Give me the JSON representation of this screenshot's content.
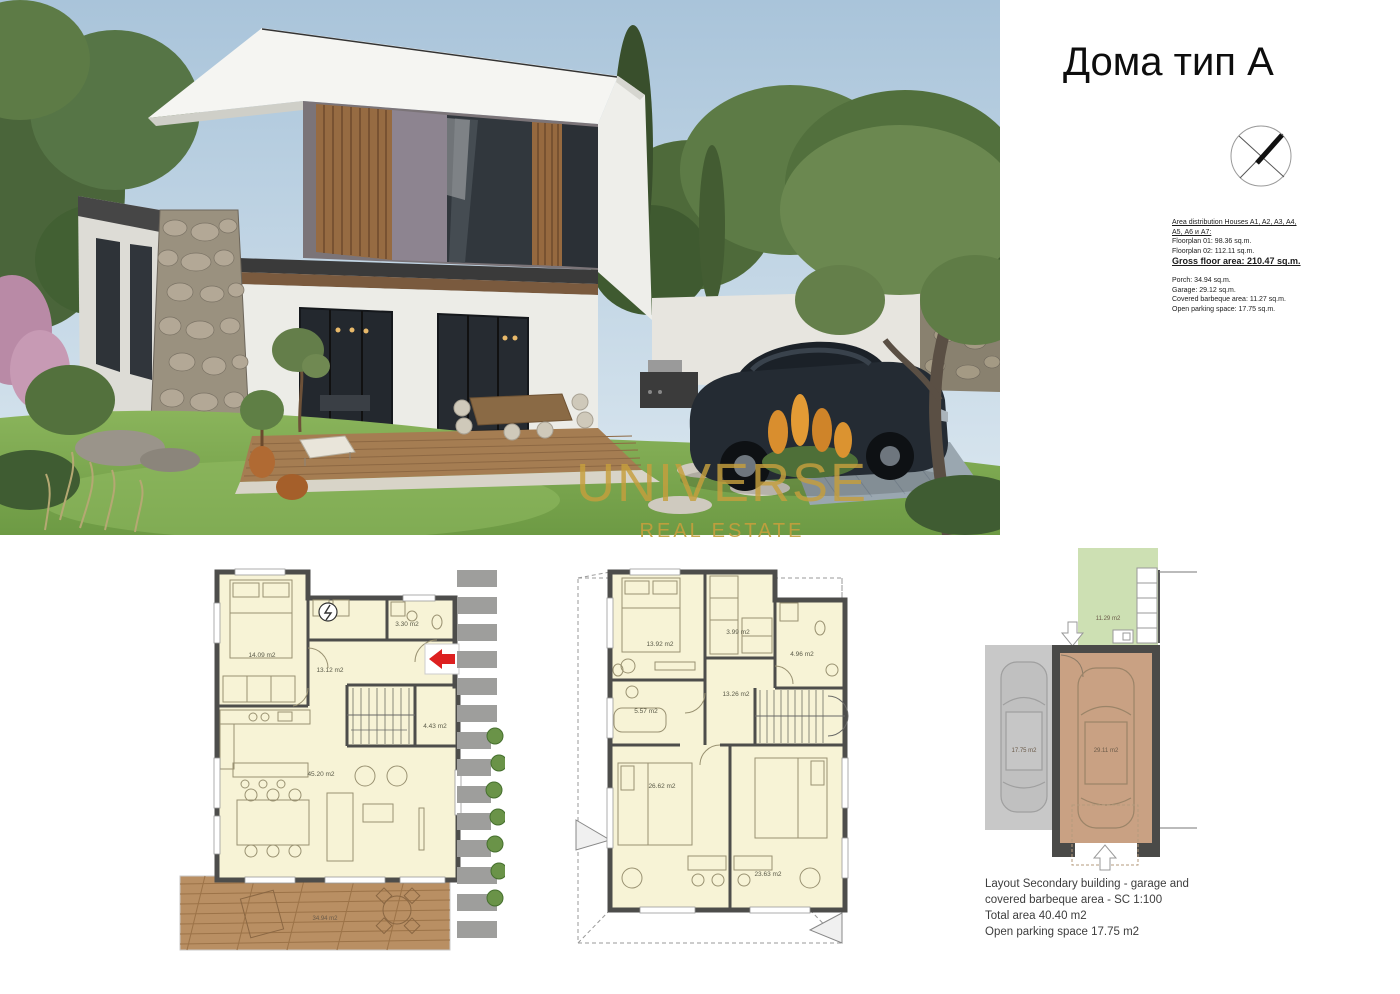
{
  "header": {
    "title": "Дома тип А"
  },
  "watermark": {
    "brand": "UNIVERSE",
    "sub": "REAL ESTATE",
    "color": "#c69f3d"
  },
  "info_block": {
    "heading_line1": "Area distribution Houses A1, A2, A3, A4,",
    "heading_line2": "A5, А6 и А7:",
    "floorplan01": "Floorplan 01: 98.36 sq.m.",
    "floorplan02": "Floorplan 02: 112.11 sq.m.",
    "gross": "Gross floor area: 210.47 sq.m.",
    "porch": "Porch: 34.94 sq.m.",
    "garage": "Garage: 29.12 sq.m.",
    "bbq": "Covered barbeque area: 11.27 sq.m.",
    "parking": "Open parking space: 17.75 sq.m."
  },
  "floorplan1": {
    "rooms": [
      {
        "label": "14.09 m2"
      },
      {
        "label": "3.30 m2"
      },
      {
        "label": "13.12 m2"
      },
      {
        "label": "4.43 m2"
      },
      {
        "label": "45.20 m2"
      },
      {
        "label": "34.94 m2"
      }
    ]
  },
  "floorplan2": {
    "rooms": [
      {
        "label": "13.92 m2"
      },
      {
        "label": "3.99 m2"
      },
      {
        "label": "4.96 m2"
      },
      {
        "label": "13.26 m2"
      },
      {
        "label": "5.57 m2"
      },
      {
        "label": "26.62 m2"
      },
      {
        "label": "23.63 m2"
      }
    ]
  },
  "garage_plan": {
    "bbq_label": "11.29 m2",
    "parking_label": "17.75 m2",
    "garage_label": "29.11 m2",
    "caption_line1": "Layout Secondary building - garage and",
    "caption_line2": "covered barbeque area - SC 1:100",
    "caption_line3": "Total area 40.40 m2",
    "caption_line4": "Open parking space 17.75 m2"
  },
  "colors": {
    "accent_red": "#dd2020",
    "gold": "#c69f3d",
    "plan_room": "#f7f3d6",
    "plan_wall": "#4d4d4b",
    "bbq_green": "#cde0b3",
    "garage_tan": "#c9a183",
    "parking_gray": "#c8c8c8"
  }
}
